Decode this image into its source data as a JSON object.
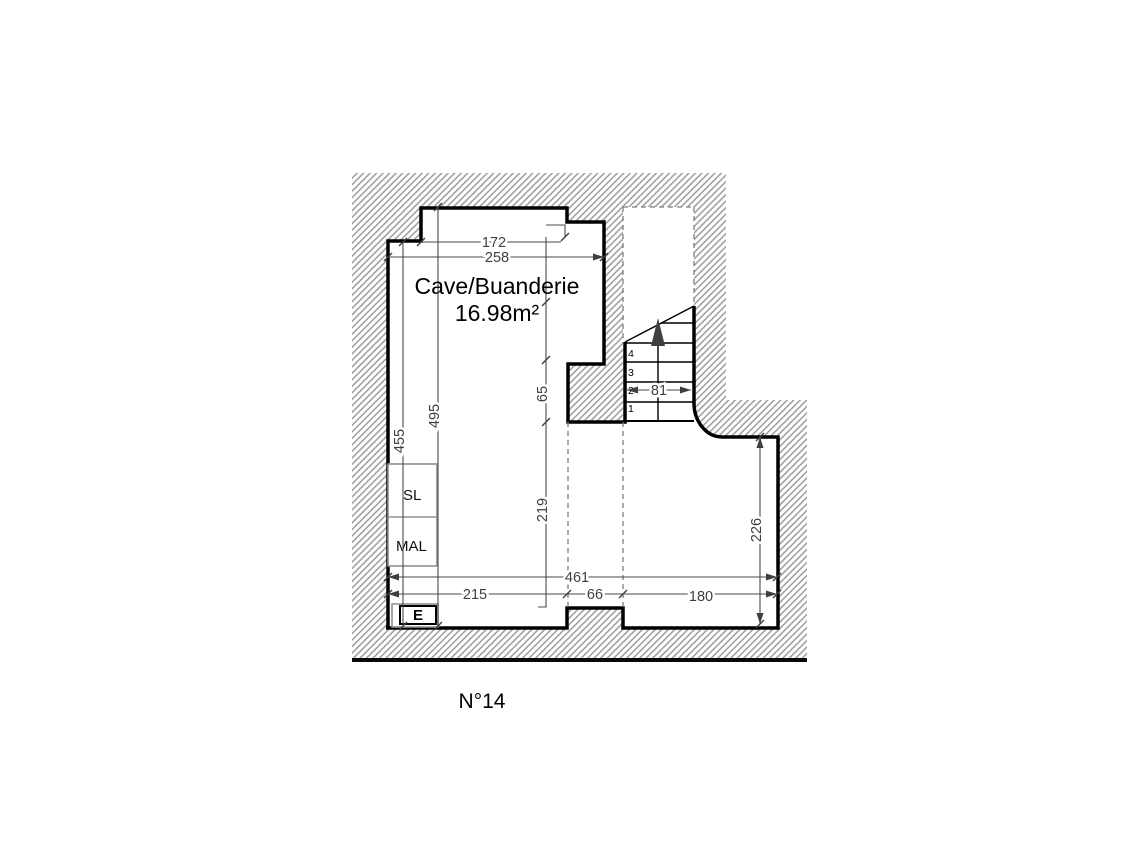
{
  "plan": {
    "room": {
      "name": "Cave/Buanderie",
      "area": "16.98m²"
    },
    "plan_number": "N°14",
    "appliances": {
      "dryer": "SL",
      "washer": "MAL",
      "electrical_panel": "E"
    },
    "stairs": {
      "step_1": "1",
      "step_2": "2",
      "step_3": "3",
      "step_4": "4",
      "width": "81"
    },
    "dimensions": {
      "top_inner_width": "172",
      "top_total_width": "258",
      "left_inner_height": "455",
      "left_total_height": "495",
      "mid_step_height": "65",
      "mid_lower_height": "219",
      "right_height": "226",
      "bottom_total_width": "461",
      "bottom_left_width": "215",
      "bottom_opening_width": "66",
      "bottom_right_width": "180"
    },
    "colors": {
      "wall": "#000000",
      "dimension": "#4a4a4a",
      "hatch": "#9b9b9b",
      "furniture": "#8f8f8f"
    }
  }
}
